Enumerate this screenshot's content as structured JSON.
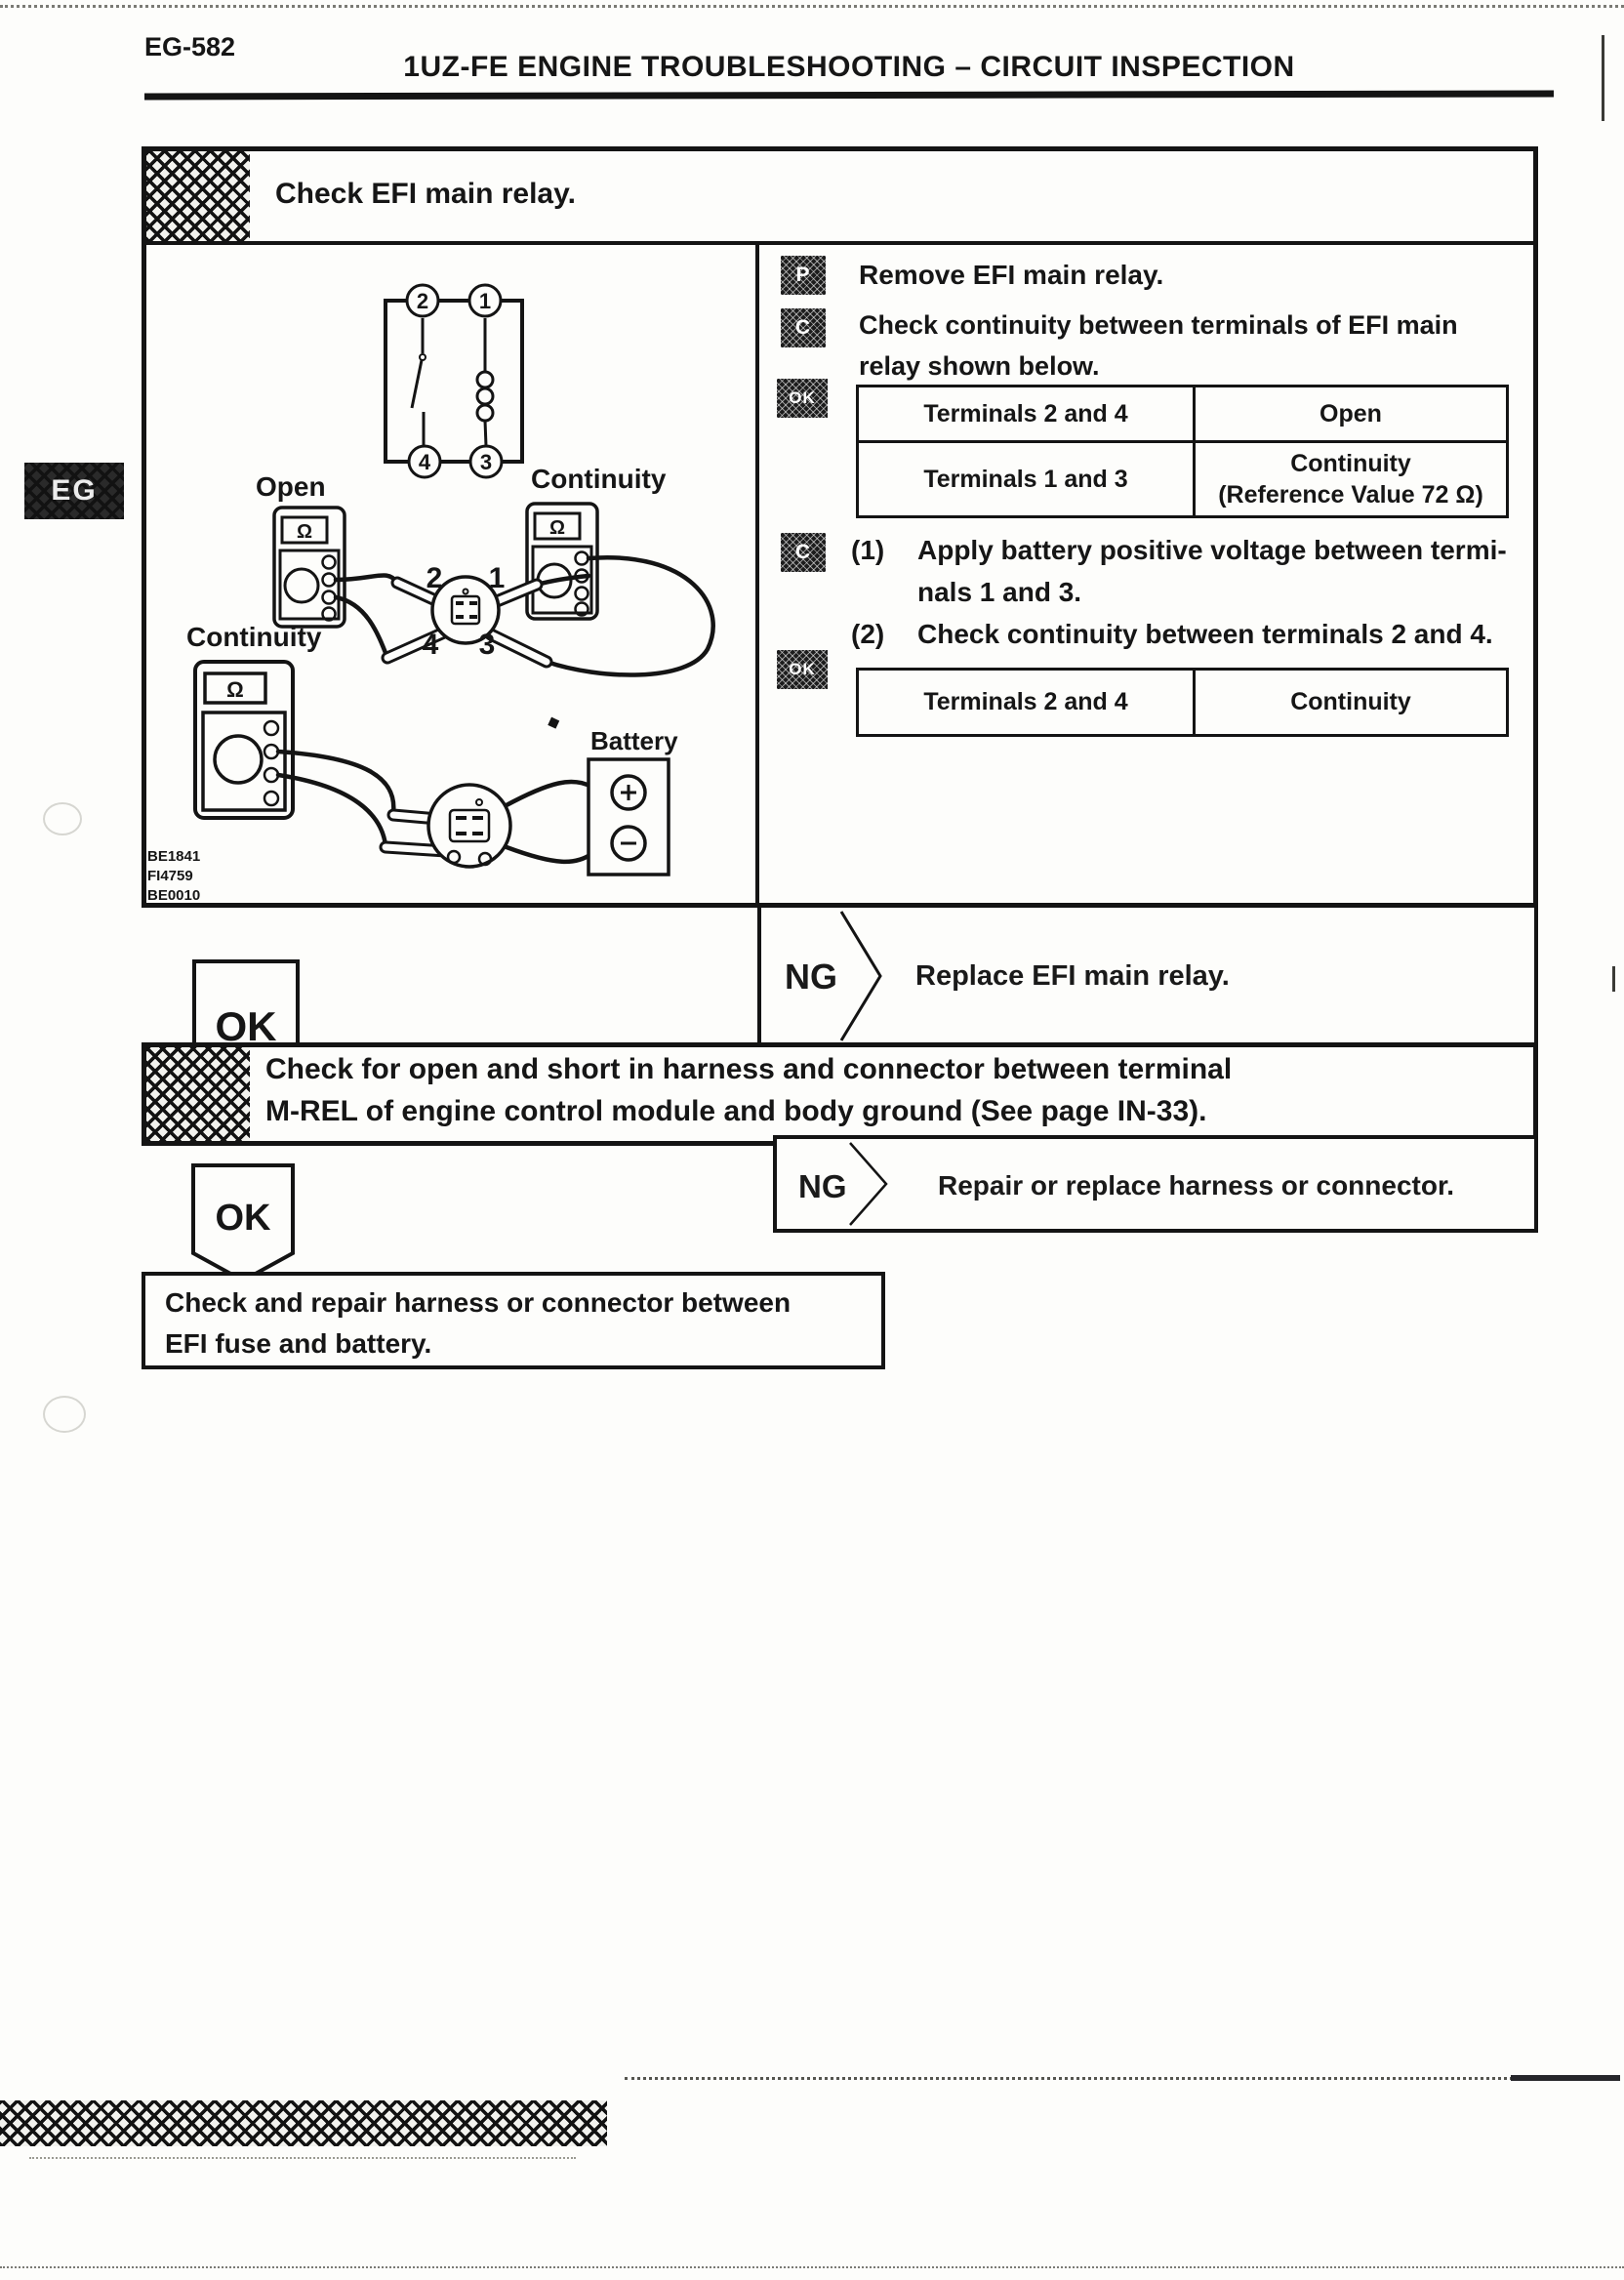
{
  "page": {
    "page_number": "EG-582",
    "header_title": "1UZ-FE ENGINE TROUBLESHOOTING – CIRCUIT INSPECTION",
    "margin_tab": "EG"
  },
  "icons": {
    "prepare": "P",
    "check": "C",
    "ok": "OK"
  },
  "step1": {
    "title": "Check EFI main relay.",
    "p_text": "Remove EFI main relay.",
    "c_lines": [
      "Check continuity between terminals of  EFI  main",
      "relay shown below."
    ],
    "table1": {
      "r1c1": "Terminals 2 and 4",
      "r1c2": "Open",
      "r2c1": "Terminals 1 and 3",
      "r2c2_line1": "Continuity",
      "r2c2_line2": "(Reference Value 72 Ω)"
    },
    "c2_lines": [
      {
        "num": "(1)",
        "text": "Apply battery positive voltage between termi-"
      },
      {
        "num": "",
        "text": "nals 1 and 3."
      },
      {
        "num": "(2)",
        "text": "Check continuity between terminals 2 and 4."
      }
    ],
    "table2": {
      "c1": "Terminals 2 and 4",
      "c2": "Continuity"
    },
    "ok_badge": "OK",
    "ng_label": "NG",
    "ng_action": "Replace EFI main relay."
  },
  "diagram": {
    "open_label": "Open",
    "continuity_top": "Continuity",
    "continuity_bottom": "Continuity",
    "battery_label": "Battery",
    "ohm": "Ω",
    "sch": {
      "t2": "2",
      "t1": "1",
      "t4": "4",
      "t3": "3"
    },
    "relay": {
      "t2": "2",
      "t1": "1",
      "t4": "4",
      "t3": "3"
    },
    "codes": [
      "BE1841",
      "FI4759",
      "BE0010"
    ]
  },
  "step2": {
    "line1": "Check for open and short in harness and connector between terminal",
    "line2": "M-REL of engine control module and body ground (See page IN-33).",
    "ok_badge": "OK",
    "ng_label": "NG",
    "ng_action": "Repair or replace harness or connector."
  },
  "final_box": {
    "line1": "Check and repair harness or connector between",
    "line2": "EFI fuse and battery."
  }
}
